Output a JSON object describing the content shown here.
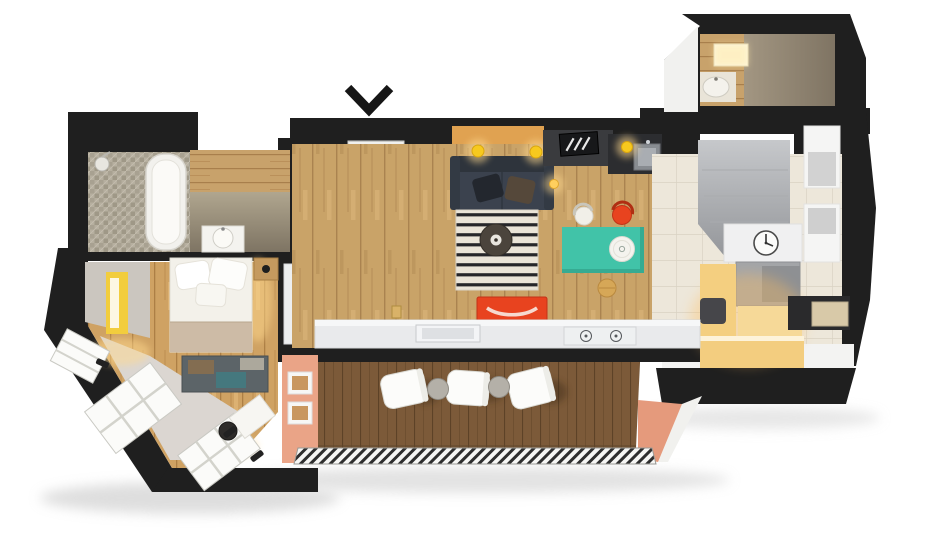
{
  "scene": {
    "kind": "3d-floor-plan-render",
    "view": "top-down cutaway of a studio apartment",
    "background": "#ffffff"
  },
  "palette": {
    "walls": "#1f1f1f",
    "chevron": "#161616",
    "wood_floor": "#c9a368",
    "wood_bedroom": "#cfa263",
    "deck_wood": "#7c5a39",
    "tile_floor": "#ede7da",
    "mosaic_floor": "#b6af9f",
    "concrete": "#948b7c",
    "rug_base": "#eae4d8",
    "rug_stripe": "#26262a",
    "sofa": "#3b424e",
    "sofa_back": "#2e343c",
    "teal": "#41c3a8",
    "red": "#e8431f",
    "yellow": "#f7c91e",
    "glow": "#ffd98e",
    "salmon": "#eaa487",
    "salmon_shade": "#e59a7c",
    "cabinet_gray": "#d9dadc",
    "shelf_gray": "#a7abb0",
    "white_furniture": "#f4f4f3",
    "wall_white_face": "#f3f3f2",
    "island_counter": "#e9eaec",
    "counter_dark": "#3a3b3e",
    "counter_dark2": "#2c2d30",
    "warm_counter": "#f4cf80",
    "bed_linen": "#f3f1ea",
    "blanket": "#cdbba6",
    "bay_floor": "#dbd6d1",
    "bedroom_gray": "#cbc6bf",
    "window_white": "#fbfbf9",
    "stool_wood": "#d6a757",
    "clock_face": "#fbfbfa",
    "appliance_dark": "#2a2a2c",
    "basin_white": "#f4f2ec",
    "niche_yellow": "#f2cd3d"
  },
  "rooms": {
    "bathroom_main": {
      "label": "bathroom",
      "features": [
        "bathtub",
        "shower-head",
        "washbasin",
        "mosaic-floor"
      ]
    },
    "bedroom": {
      "label": "bedroom",
      "features": [
        "double-bed",
        "pillows",
        "nightstand-lamp",
        "patterned-rug",
        "lit-wall-niche"
      ]
    },
    "glazed_bay": {
      "label": "angled glazed bay",
      "features": [
        "panoramic-windows",
        "desk",
        "chair",
        "wall-sconces"
      ]
    },
    "entry": {
      "label": "entry",
      "features": [
        "wardrobe",
        "open-shelving",
        "striped-doormat",
        "tall-closet"
      ]
    },
    "living": {
      "label": "living room",
      "features": [
        "sofa",
        "striped-rug",
        "round-coffee-table",
        "teal-dining-table",
        "dining-chairs",
        "pendant-lamps",
        "red-wall-console"
      ]
    },
    "kitchen": {
      "label": "kitchen",
      "features": [
        "island-sink",
        "gas-hob",
        "hood-cabinet",
        "wall-clock",
        "tall-niches",
        "warm-lit-counters"
      ]
    },
    "wc": {
      "label": "wc",
      "features": [
        "washbasin",
        "ceiling-skylight",
        "concrete-walls"
      ]
    },
    "terrace": {
      "label": "terrace bar",
      "features": [
        "three-white-chairs",
        "two-side-tables",
        "wood-deck",
        "striped-walkway"
      ]
    }
  },
  "indicators": {
    "entrance_arrow": "chevron-down"
  }
}
